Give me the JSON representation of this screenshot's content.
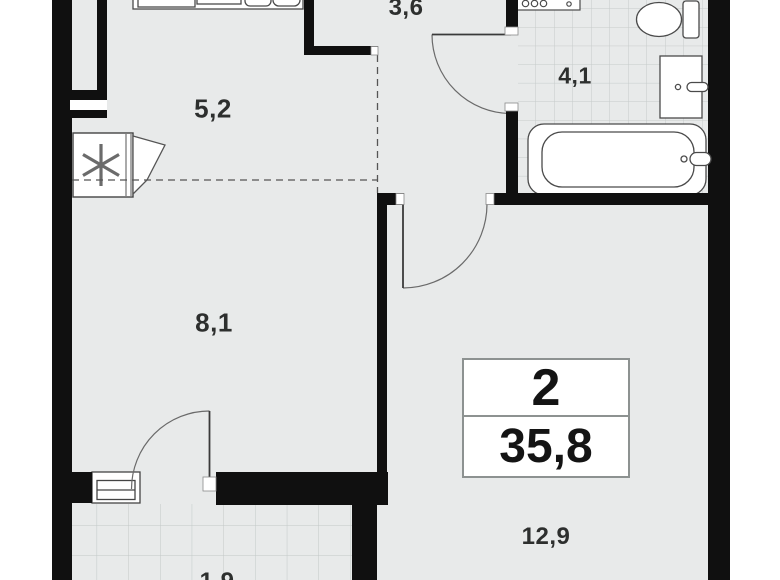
{
  "plan": {
    "type_label": "floor-plan",
    "rooms_count": "2",
    "total_area": "35,8",
    "labels": {
      "kitchen_zone": "5,2",
      "hall": "3,6",
      "bathroom": "4,1",
      "room_zone": "8,1",
      "living_room": "12,9",
      "balcony": "1,9"
    },
    "icons": {
      "ventilation": "asterisk-6-spoke"
    },
    "colors": {
      "wall": "#101010",
      "floor": "#e8eaea",
      "tile_line": "#c6cbca",
      "fixture_outline": "#4a4a4a",
      "label_text": "#2d2f2e"
    }
  }
}
